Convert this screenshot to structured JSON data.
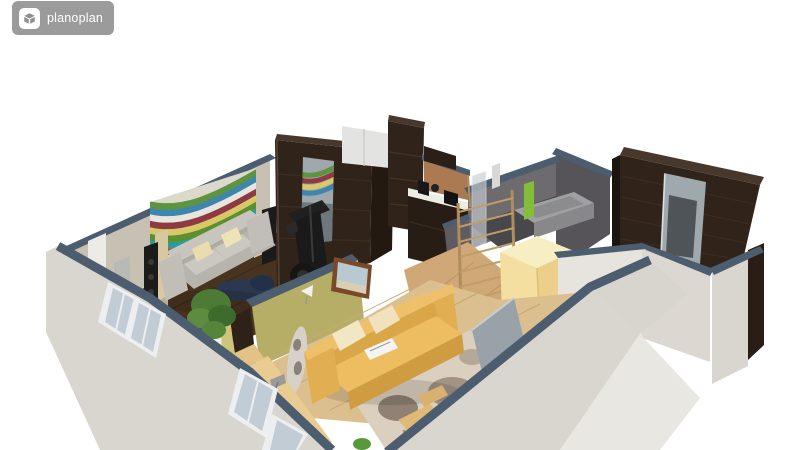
{
  "app": {
    "logo": {
      "text": "planoplan",
      "badge_bg": "#9b9b9b",
      "text_color": "#ffffff",
      "icon_bg": "#ffffff",
      "icon_glyph": "#8f8f8f"
    }
  },
  "scene": {
    "view": "3d-isometric-apartment-cutaway"
  },
  "palette": {
    "slate": "#4c5d6f",
    "exterior_wall": "#d9d6cf",
    "exterior_wall_light": "#e9e7e1",
    "interior_wall_beige": "#c7c0b3",
    "door_white": "#edebe5",
    "olive_wall_lit": "#cdc57b",
    "olive_wall_shaded": "#b6ae66",
    "dark_wood_floor": "#48331f",
    "bottom_room_floor": "#dcbf8e",
    "hall_floor": "#d0a878",
    "wenge": "#30231a",
    "wenge_dark": "#231911",
    "wenge_top": "#48382b",
    "mirror_glass": "#9fa8ac",
    "mirror_glass_dark": "#6e787c",
    "gray_sofa": "#b7b4ad",
    "gray_sofa_light": "#c8c5be",
    "cream_pillow": "#e9ddb0",
    "yellow_sofa": "#edbd62",
    "yellow_sofa_deep": "#d9a648",
    "yellow_wardrobe_front": "#f4dfa0",
    "yellow_wardrobe_side": "#eccf88",
    "yellow_wardrobe_top": "#f8eec4",
    "bathroom_wall": "#6e6b6e",
    "bathroom_wall_dark": "#565458",
    "bathroom_floor": "#48484c",
    "tub": "#a0a0a2",
    "towel_green": "#84bd3a",
    "ladder_wood": "#b08c5c",
    "desk_wood": "#e9cc92",
    "chair_wood": "#e0b878",
    "rug_base": "#dbd0c0",
    "stone_dark": "#8f8173",
    "stone_mid": "#a29484",
    "stone_light": "#b5a896",
    "stone_orange": "#c28a4e",
    "plant_green": "#4d7b36",
    "window_frame": "#eceef0",
    "window_glass": "#c2ccd4",
    "speaker_black": "#1b1b1b",
    "picture_frame": "#7a4a28",
    "picture_image": "#b9c9d1",
    "kitchen_counter": "#eeede5",
    "backsplash_tan": "#ac7a50",
    "fridge_white": "#e3e3e1",
    "navy_rug": "#2c3850",
    "surfboard": "#d6d2ca",
    "mural_stripes": [
      "#5e9440",
      "#3f86ae",
      "#e8e5dc",
      "#8e3a44",
      "#d9c867",
      "#5b8f2f",
      "#2e9c96",
      "#b45a3a",
      "#cfd9a0",
      "#34568a",
      "#6fae3f",
      "#7a2f3a",
      "#c8b84e",
      "#8fb9d0"
    ]
  }
}
